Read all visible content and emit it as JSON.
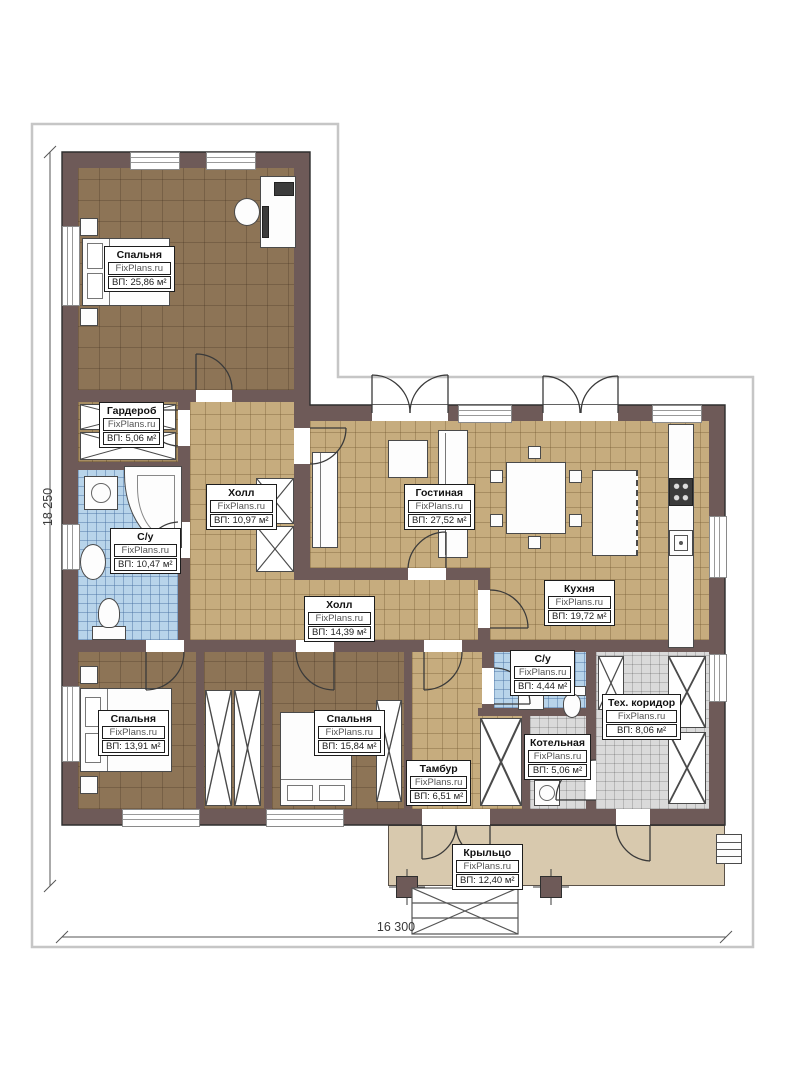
{
  "plan": {
    "watermark": "FixPlans.ru",
    "dimensions": {
      "height_label": "18 250",
      "width_label": "16 300"
    },
    "colors": {
      "wall": "#6e5a58",
      "floor_wood": "#8d7456",
      "floor_tile": "#c6ac7e",
      "floor_bath": "#b8d4ea",
      "floor_tech": "#dadada",
      "porch": "#d8c9ae"
    },
    "rooms": [
      {
        "name": "Спальня",
        "area": "ВП: 25,86 м²"
      },
      {
        "name": "Гардероб",
        "area": "ВП: 5,06 м²"
      },
      {
        "name": "Холл",
        "area": "ВП: 10,97 м²"
      },
      {
        "name": "С/у",
        "area": "ВП: 10,47 м²"
      },
      {
        "name": "Гостиная",
        "area": "ВП: 27,52 м²"
      },
      {
        "name": "Кухня",
        "area": "ВП: 19,72 м²"
      },
      {
        "name": "Холл",
        "area": "ВП: 14,39 м²"
      },
      {
        "name": "Спальня",
        "area": "ВП: 13,91 м²"
      },
      {
        "name": "Спальня",
        "area": "ВП: 15,84 м²"
      },
      {
        "name": "Тамбур",
        "area": "ВП: 6,51 м²"
      },
      {
        "name": "С/у",
        "area": "ВП: 4,44 м²"
      },
      {
        "name": "Котельная",
        "area": "ВП: 5,06 м²"
      },
      {
        "name": "Тех. коридор",
        "area": "ВП: 8,06 м²"
      },
      {
        "name": "Крыльцо",
        "area": "ВП: 12,40 м²"
      }
    ]
  }
}
